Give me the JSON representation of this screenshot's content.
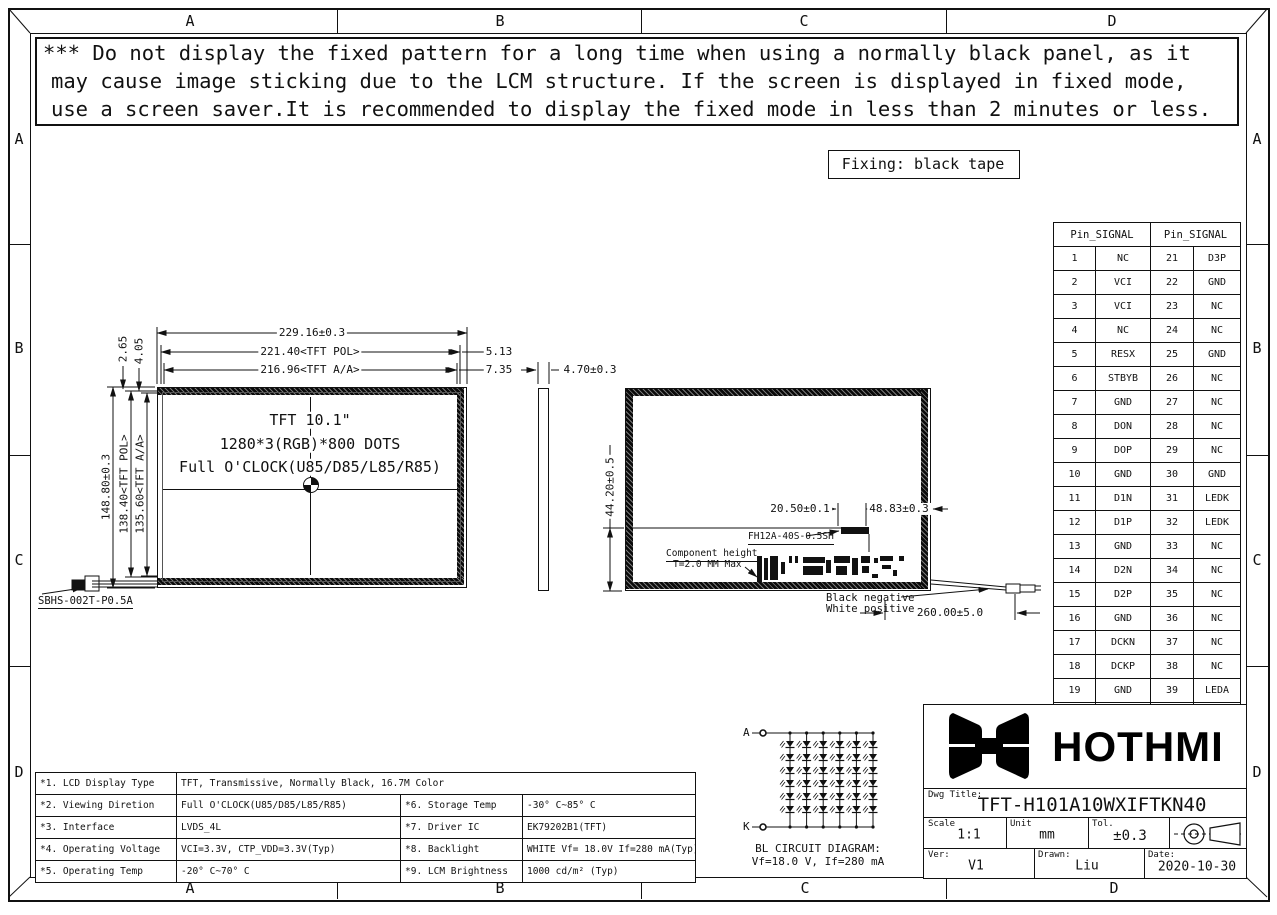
{
  "sheet": {
    "col_labels": [
      "A",
      "B",
      "C",
      "D"
    ],
    "row_labels": [
      "A",
      "B",
      "C",
      "D"
    ],
    "colors": {
      "line": "#111111",
      "bg": "#ffffff"
    }
  },
  "warning": {
    "line1": "*** Do not display the fixed pattern for a long time when using a normally black panel, as it",
    "line2": "may cause image sticking due to the LCM structure. If the screen is displayed in fixed mode,",
    "line3": "use a screen saver.It is recommended to display the fixed mode in less than 2 minutes or less."
  },
  "fixing_note": "Fixing: black tape",
  "front_view": {
    "line1": "TFT 10.1\"",
    "line2": "1280*3(RGB)*800 DOTS",
    "line3": "Full O'CLOCK(U85/D85/L85/R85)",
    "dim_width_outline": "229.16±0.3",
    "dim_width_pol": "221.40<TFT POL>",
    "dim_width_aa": "216.96<TFT A/A>",
    "dim_right_1": "5.13",
    "dim_right_2": "7.35",
    "dim_height_outline": "148.80±0.3",
    "dim_height_pol": "138.40<TFT POL>",
    "dim_height_aa": "135.60<TFT A/A>",
    "dim_top_1": "2.65",
    "dim_top_2": "4.05",
    "connector_label": "SBHS-002T-P0.5A"
  },
  "side_view": {
    "dim_thickness": "4.70±0.3"
  },
  "back_view": {
    "dim_height": "44.20±0.5",
    "dim_conn_offset": "20.50±0.1",
    "dim_conn_right": "48.83±0.3",
    "connector_label": "FH12A-40S-0.5SH",
    "component_note_line1": "Component height",
    "component_note_line2": "T=2.0 MM Max",
    "wire_note_line1": "Black negative",
    "wire_note_line2": "White positive",
    "dim_wire_length": "260.00±5.0"
  },
  "pin_table": {
    "header": "Pin_SIGNAL",
    "rows": [
      [
        "1",
        "NC",
        "21",
        "D3P"
      ],
      [
        "2",
        "VCI",
        "22",
        "GND"
      ],
      [
        "3",
        "VCI",
        "23",
        "NC"
      ],
      [
        "4",
        "NC",
        "24",
        "NC"
      ],
      [
        "5",
        "RESX",
        "25",
        "GND"
      ],
      [
        "6",
        "STBYB",
        "26",
        "NC"
      ],
      [
        "7",
        "GND",
        "27",
        "NC"
      ],
      [
        "8",
        "DON",
        "28",
        "NC"
      ],
      [
        "9",
        "DOP",
        "29",
        "NC"
      ],
      [
        "10",
        "GND",
        "30",
        "GND"
      ],
      [
        "11",
        "D1N",
        "31",
        "LEDK"
      ],
      [
        "12",
        "D1P",
        "32",
        "LEDK"
      ],
      [
        "13",
        "GND",
        "33",
        "NC"
      ],
      [
        "14",
        "D2N",
        "34",
        "NC"
      ],
      [
        "15",
        "D2P",
        "35",
        "NC"
      ],
      [
        "16",
        "GND",
        "36",
        "NC"
      ],
      [
        "17",
        "DCKN",
        "37",
        "NC"
      ],
      [
        "18",
        "DCKP",
        "38",
        "NC"
      ],
      [
        "19",
        "GND",
        "39",
        "LEDA"
      ],
      [
        "20",
        "D3N",
        "40",
        "LEDA"
      ]
    ]
  },
  "spec_table": {
    "rows": [
      {
        "c": [
          "*1. LCD Display Type",
          "TFT, Transmissive, Normally Black, 16.7M Color"
        ]
      },
      {
        "c": [
          "*2. Viewing Diretion",
          "Full O'CLOCK(U85/D85/L85/R85)",
          "*6. Storage Temp",
          "-30° C~85° C"
        ]
      },
      {
        "c": [
          "*3. Interface",
          "LVDS_4L",
          "*7. Driver IC",
          "EK79202B1(TFT)"
        ]
      },
      {
        "c": [
          "*4. Operating Voltage",
          "VCI=3.3V, CTP_VDD=3.3V(Typ)",
          "*8. Backlight",
          "WHITE Vf= 18.0V If=280 mA(Typ)"
        ]
      },
      {
        "c": [
          "*5. Operating Temp",
          "-20° C~70° C",
          "*9. LCM Brightness",
          "1000 cd/m² (Typ)"
        ]
      }
    ]
  },
  "bl_circuit": {
    "anode": "A",
    "cathode": "K",
    "rows": 6,
    "cols": 6,
    "caption1": "BL CIRCUIT DIAGRAM:",
    "caption2": "Vf=18.0 V, If=280 mA"
  },
  "title_block": {
    "brand": "HOTHMI",
    "dwg_title_label": "Dwg Title:",
    "dwg_title": "TFT-H101A10WXIFTKN40",
    "scale_label": "Scale",
    "scale": "1:1",
    "unit_label": "Unit",
    "unit": "mm",
    "tol_label": "Tol.",
    "tol": "±0.3",
    "ver_label": "Ver:",
    "ver": "V1",
    "drawn_label": "Drawn:",
    "drawn": "Liu",
    "date_label": "Date:",
    "date": "2020-10-30"
  }
}
